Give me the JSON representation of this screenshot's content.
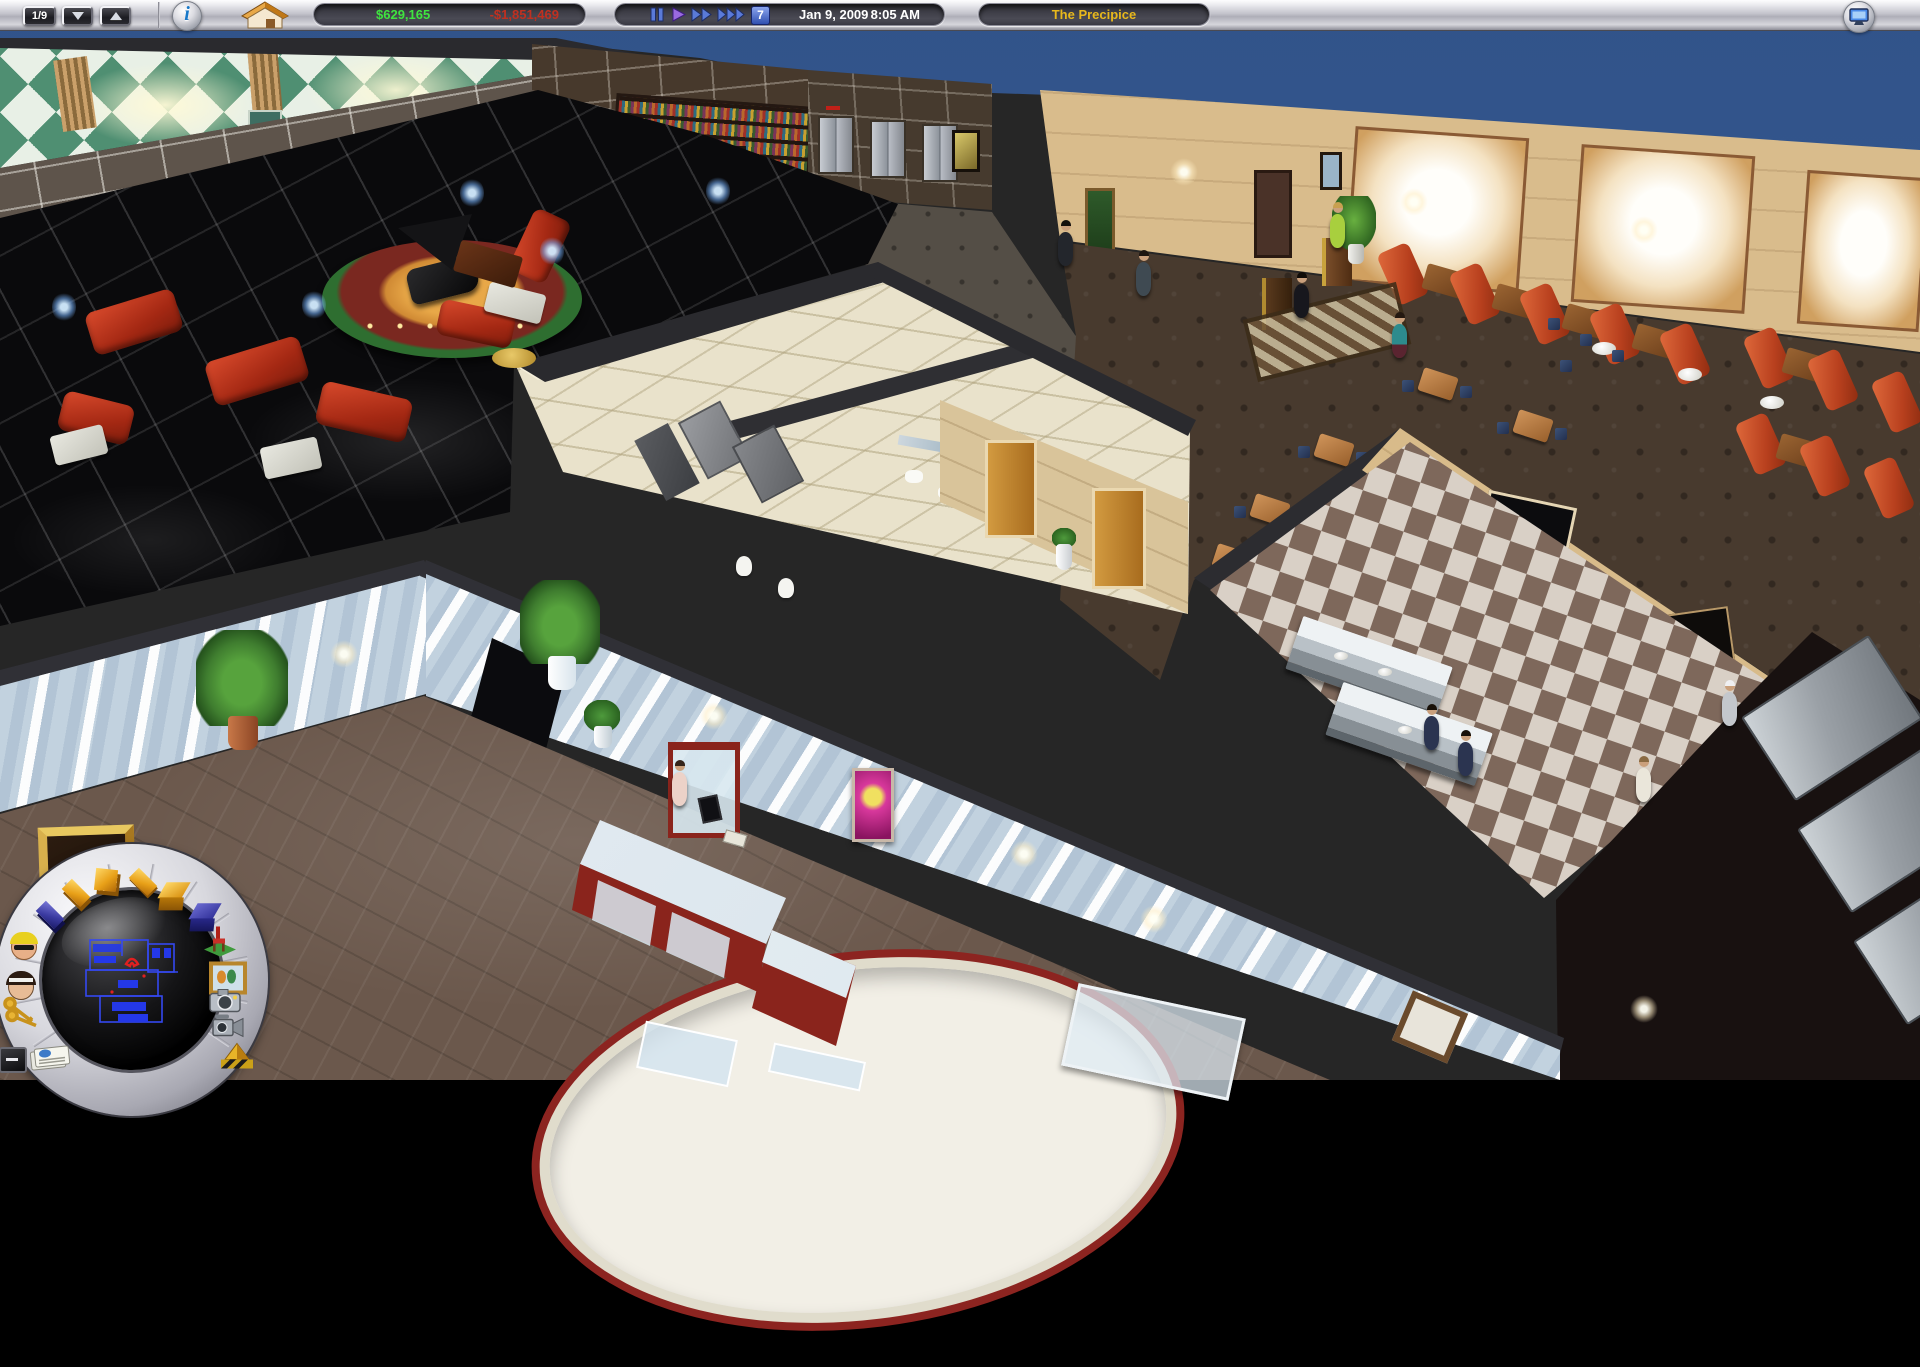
{
  "toolbar": {
    "floor_indicator": "1/9",
    "balance": "$629,165",
    "loss": "-$1,851,469",
    "calendar_day": "7",
    "date": "Jan 9, 2009",
    "time": "8:05 AM",
    "hotel_name": "The Precipice",
    "icons": [
      "floor-down-icon",
      "floor-up-icon",
      "info-icon",
      "hotel-house-icon",
      "pause-icon",
      "play-icon",
      "fast-forward-icon",
      "fastest-forward-icon",
      "calendar-day-button",
      "screen-monitor-icon"
    ],
    "colors": {
      "balance_positive": "#3fe43f",
      "balance_negative": "#c03020",
      "hotel_name": "#e8b81c"
    }
  },
  "radial_menu": {
    "tool_icons": [
      "floor-tile-blue-icon",
      "floor-tile-gold-icon",
      "tile-gold-square-icon",
      "tile-gold-flat-icon",
      "room-box-gold-icon",
      "room-box-blue-icon",
      "furniture-chair-icon",
      "pictures-icon",
      "camera-icon",
      "video-camera-icon",
      "construction-icon",
      "guest-man-icon",
      "staff-woman-icon",
      "room-keys-icon",
      "minimize-icon",
      "newspaper-icon"
    ],
    "minimap": {
      "type": "floor-blueprint",
      "line_color": "#3448f0",
      "marker_color": "#e02020"
    }
  },
  "scene": {
    "regions": [
      "piano-lounge",
      "library",
      "elevator-hall",
      "restaurant",
      "restrooms",
      "kitchen",
      "lobby",
      "storage-room"
    ],
    "colors": {
      "sky": "#36598c",
      "lounge_floor": "#0a0a0c",
      "restaurant_wall": "#d9bc8c",
      "lobby_wall": "#c2d2df",
      "marble_floor": "#6b584c"
    }
  }
}
